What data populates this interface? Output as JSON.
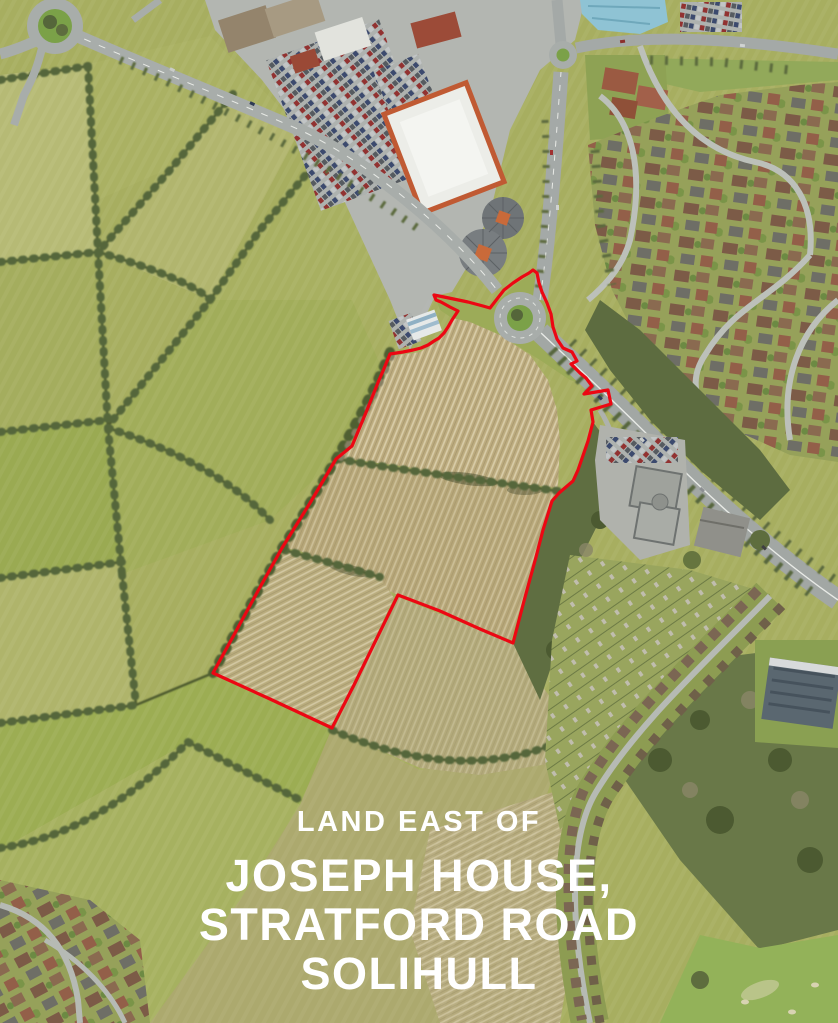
{
  "page": {
    "kind": "aerial-site-marketing-image",
    "width": 838,
    "height": 1023
  },
  "overlay": {
    "subtitle": "LAND EAST OF",
    "title_line1": "JOSEPH HOUSE,",
    "title_line2": "STRATFORD ROAD",
    "title_line3": "SOLIHULL",
    "text_color": "#ffffff"
  },
  "site_boundary": {
    "color": "#ec0713",
    "stroke_width": 3.2,
    "points": "434,295 444,297 468,302 483,306 490,308 497,299 504,290 513,283 522,277 529,273 533,270 537,273 539,283 542,292 547,303 551,314 553,327 557,339 563,348 572,352 577,361 571,364 576,369 580,373 586,378 592,386 584,394 608,390 611,404 591,410 593,422 588,441 578,470 573,481 559,493 552,501 543,530 536,557 524,601 513,643 480,629 440,611 398,595 376,640 354,685 332,728 270,699 213,673 235,633 259,589 282,548 310,503 336,459 352,446 367,410 379,380 383,371 390,354 403,352 413,350 421,348 428,345 434,341 439,338 444,333 448,327 452,320 456,314 458,311 450,307 441,302 436,300"
  }
}
